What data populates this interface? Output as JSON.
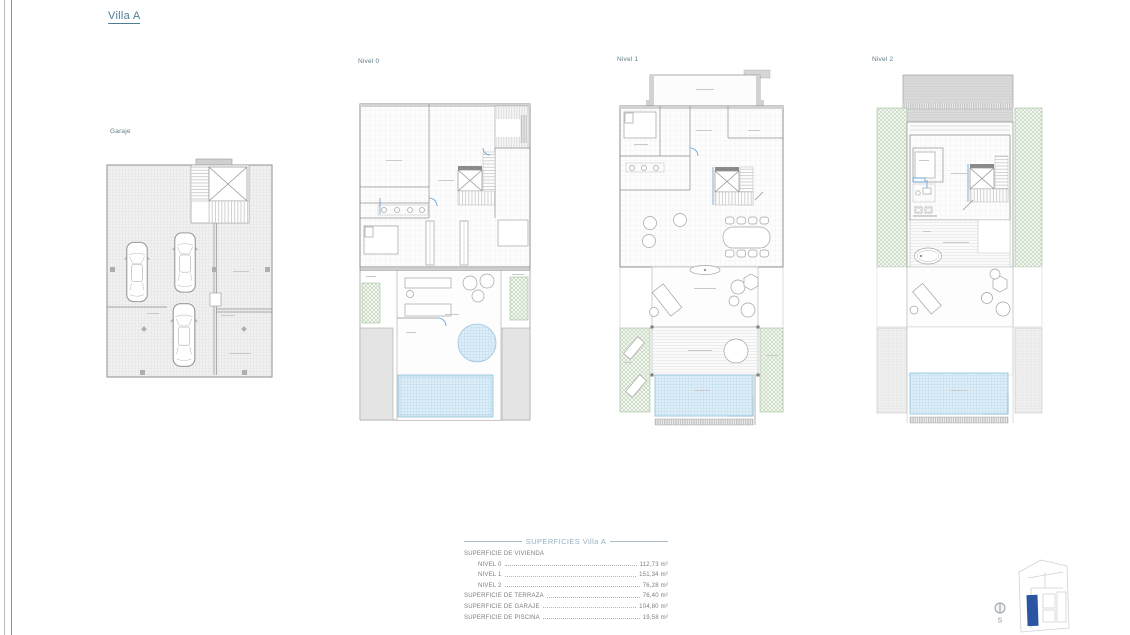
{
  "page": {
    "title": "Villa A"
  },
  "plan_labels": {
    "garaje": "Garaje",
    "nivel0": "Nivel 0",
    "nivel1": "Nivel 1",
    "nivel2": "Nivel 2"
  },
  "surfaces_table": {
    "title": "SUPERFICIES Villa A",
    "section_label": "SUPERFICIE DE VIVIENDA",
    "rows": [
      {
        "label": "NIVEL 0",
        "value": "112,73 m²"
      },
      {
        "label": "NIVEL 1",
        "value": "151,34 m²"
      },
      {
        "label": "NIVEL 2",
        "value": "76,28 m²"
      },
      {
        "label": "SUPERFICIE DE TERRAZA",
        "value": "76,40 m²"
      },
      {
        "label": "SUPERFICIE DE GARAJE",
        "value": "104,80 m²"
      },
      {
        "label": "SUPERFICIE DE PISCINA",
        "value": "19,58 m²"
      }
    ]
  },
  "site_locator": {
    "compass_south_label": "S"
  },
  "colors": {
    "title_blue": "#4e7d97",
    "table_title_blue": "#93b2c2",
    "location_marker_blue": "#2b55a3",
    "pool_blue": "#ddeef8",
    "vegetation_green": "#a8c79f"
  }
}
